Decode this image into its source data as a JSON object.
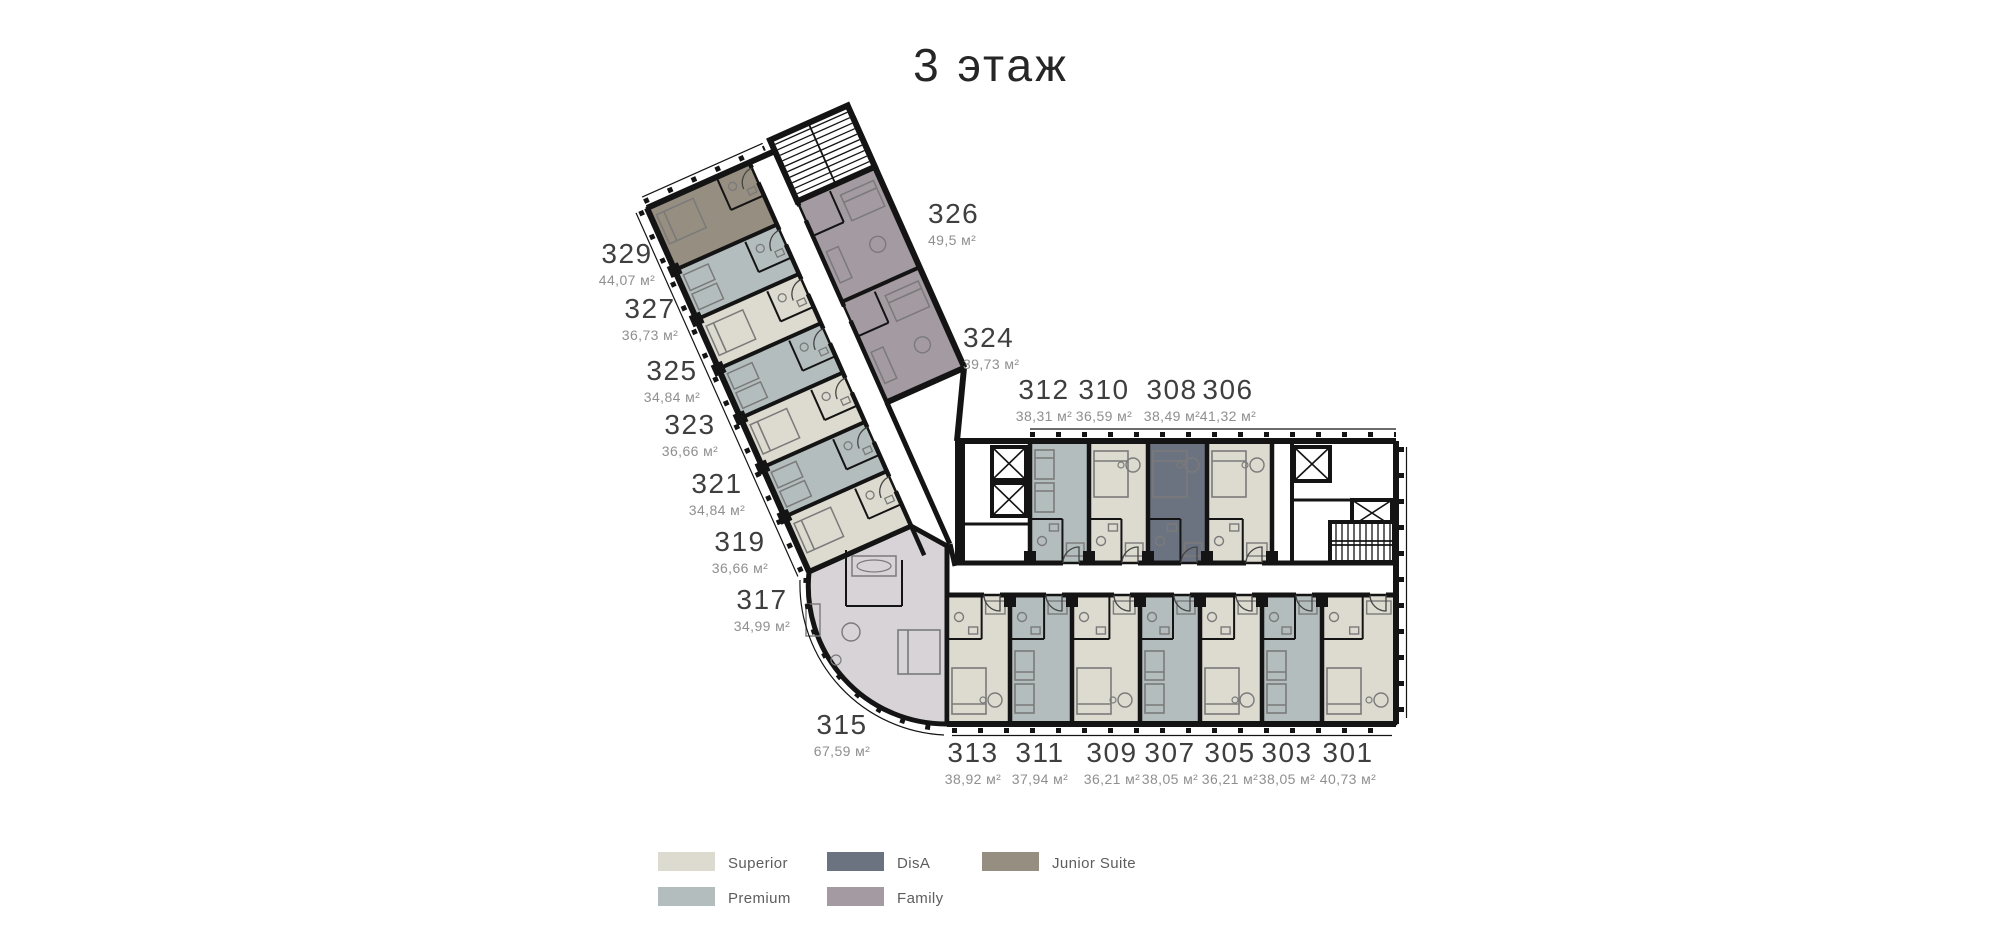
{
  "title": "3 этаж",
  "legend": {
    "items": [
      {
        "label": "Superior",
        "color": "#dddacf"
      },
      {
        "label": "Premium",
        "color": "#b4bdbd"
      },
      {
        "label": "DisA",
        "color": "#6c7380"
      },
      {
        "label": "Family",
        "color": "#a49aa2"
      },
      {
        "label": "Junior Suite",
        "color": "#968e80"
      }
    ]
  },
  "colors": {
    "walls": "#141414",
    "room_315": "#d8d3d7",
    "corridor": "#ffffff"
  },
  "rooms": [
    {
      "number": "329",
      "area": "44,07 м²",
      "type": "Junior Suite"
    },
    {
      "number": "327",
      "area": "36,73 м²",
      "type": "Premium"
    },
    {
      "number": "325",
      "area": "34,84 м²",
      "type": "Superior"
    },
    {
      "number": "323",
      "area": "36,66 м²",
      "type": "Premium"
    },
    {
      "number": "321",
      "area": "34,84 м²",
      "type": "Superior"
    },
    {
      "number": "319",
      "area": "36,66 м²",
      "type": "Premium"
    },
    {
      "number": "317",
      "area": "34,99 м²",
      "type": "Superior"
    },
    {
      "number": "315",
      "area": "67,59 м²",
      "type": ""
    },
    {
      "number": "326",
      "area": "49,5 м²",
      "type": "Family"
    },
    {
      "number": "324",
      "area": "39,73 м²",
      "type": "Family"
    },
    {
      "number": "312",
      "area": "38,31 м²",
      "type": "Premium"
    },
    {
      "number": "310",
      "area": "36,59 м²",
      "type": "Superior"
    },
    {
      "number": "308",
      "area": "38,49 м²",
      "type": "DisA"
    },
    {
      "number": "306",
      "area": "41,32 м²",
      "type": "Superior"
    },
    {
      "number": "313",
      "area": "38,92 м²",
      "type": "Superior"
    },
    {
      "number": "311",
      "area": "37,94 м²",
      "type": "Premium"
    },
    {
      "number": "309",
      "area": "36,21 м²",
      "type": "Superior"
    },
    {
      "number": "307",
      "area": "38,05 м²",
      "type": "Premium"
    },
    {
      "number": "305",
      "area": "36,21 м²",
      "type": "Superior"
    },
    {
      "number": "303",
      "area": "38,05 м²",
      "type": "Premium"
    },
    {
      "number": "301",
      "area": "40,73 м²",
      "type": "Superior"
    }
  ]
}
